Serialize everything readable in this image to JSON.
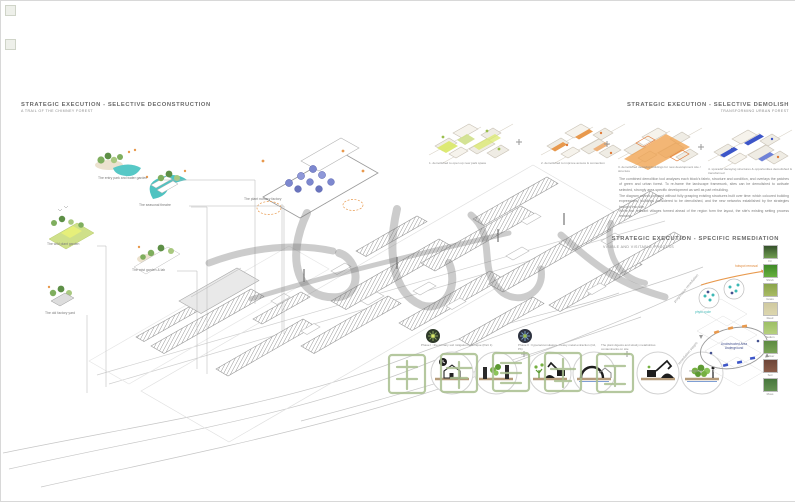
{
  "titles": {
    "left": {
      "title": "STRATEGIC EXECUTION - SELECTIVE DECONSTRUCTION",
      "subtitle": "A TRAIL OF THE CHIMNEY FOREST"
    },
    "right": {
      "title": "STRATEGIC EXECUTION - SELECTIVE DEMOLISH",
      "subtitle": "TRANSFORMING URBAN FOREST"
    },
    "remediation": {
      "title": "STRATEGIC EXECUTION - SPECIFIC REMEDIATION",
      "subtitle": "VISIBLE AND VISITABLE PROCESS"
    }
  },
  "demolition_steps": [
    {
      "caption": "1. demolished to open up new park space"
    },
    {
      "caption": "2. demolished to improve access & connection"
    },
    {
      "caption": "3. demolished decaying buildings for new development site / structure"
    },
    {
      "caption": "4. sporadic decaying structures & opportunities demolished & transformed"
    }
  ],
  "paragraphs": [
    "The combined demolition tool analyses each block's fabric, structure and condition, and overlays the patches of green and urban forest. To re-frame the landscape framework, sites can be demolished to activate selected, strongly area-specific development as well as part rebuilding.",
    "The diagram cannot proceed without fully grasping existing structures built over time: which coloured building expressions, buildings considered to be demolished, and the new networks established by the strategies brought into site.",
    "While the relevant villages formed ahead of the region form the layout, the site's existing setting process remains."
  ],
  "vignettes": [
    {
      "label": "The entry park and water garden"
    },
    {
      "label": "The seasonal theatre"
    },
    {
      "label": "The wild plant garden"
    },
    {
      "label": "The mist garden & lab"
    },
    {
      "label": "The old factory yard"
    }
  ],
  "axon_caption": "The plant nursery factory",
  "process": {
    "captions": [
      "Phase I : the primary soil mitigation technique (Part 1)",
      "Phase II : hyperaccumulators - heavy metal extraction (Cd, Pb)",
      "The plant digests and slowly metabolizes contaminants on site"
    ]
  },
  "remediation_diagram": {
    "rotated_label": "progressive remediation",
    "rotated_label2": "remediation stages",
    "mapping_label": "mapping",
    "center_label_top": "Unobstructed Area",
    "center_label_bottom": "Underground",
    "annotation_orange": "hotspot removal",
    "annotation_teal": "phyto cycle"
  },
  "plants": [
    {
      "name": "Fir"
    },
    {
      "name": "Shrub"
    },
    {
      "name": "Grass"
    },
    {
      "name": "Reed"
    },
    {
      "name": "Sedum"
    },
    {
      "name": "Vetiver"
    },
    {
      "name": "Soil"
    },
    {
      "name": "Moss"
    }
  ],
  "watermark": {
    "center": "一品优集",
    "bottom": "作品集辅导"
  },
  "colors": {
    "teal": "#4fc3c1",
    "orange": "#e8994d",
    "green": "#7fae5e",
    "yellowgreen": "#dbe96e",
    "blue": "#3c55c8",
    "purple": "#7d88cf"
  }
}
